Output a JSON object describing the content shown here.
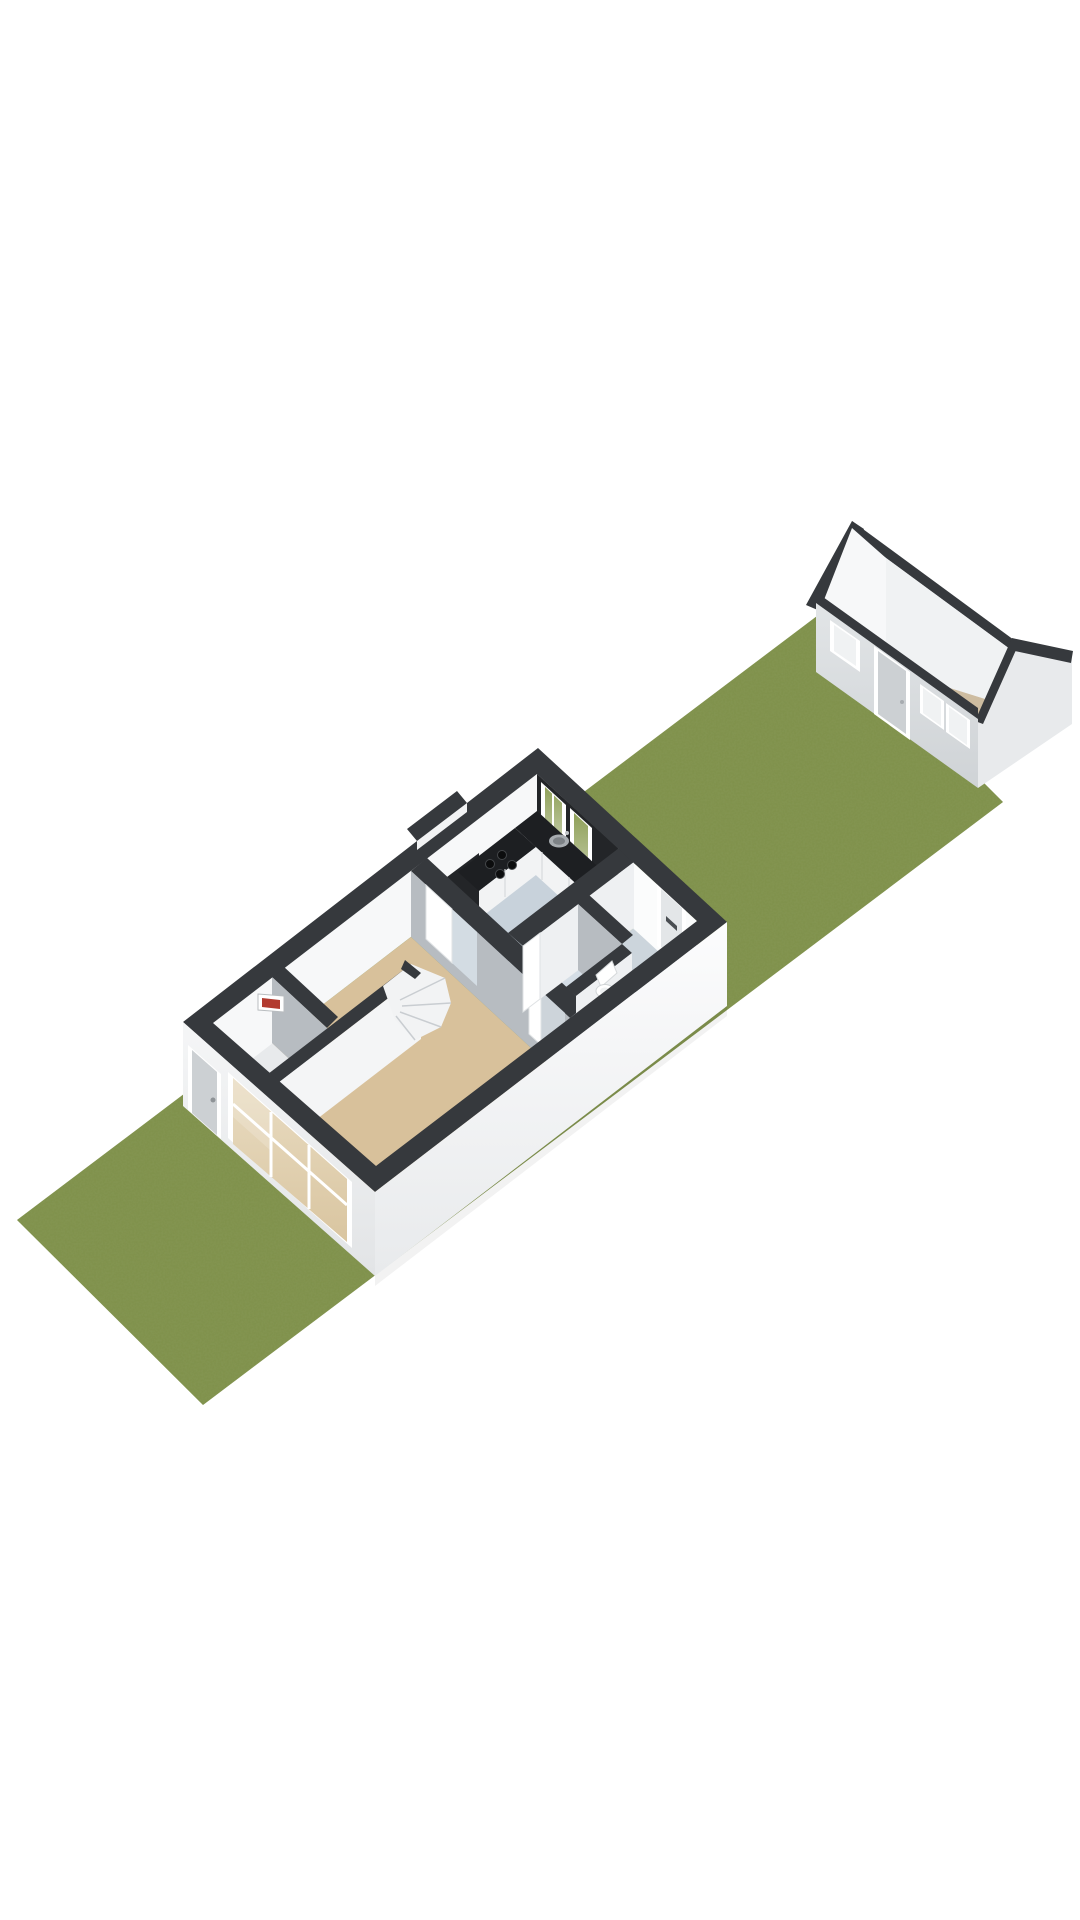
{
  "title": "3D floor plan - ground floor cutaway with garden strip and detached shed",
  "palette": {
    "bg": "#ffffff",
    "trim": "#36393d",
    "lawn": "#7e9049",
    "lawnDark": "#5e7036",
    "floorLiving": "#d8c19b",
    "floorKitchen": "#c8d2db",
    "floorHall": "#ccd5dc",
    "floorToilet": "#d5dee6",
    "floorShed": "#cdbca0",
    "closetFloor": "#e8eaec",
    "interiorWhite": "#f7f8f9",
    "interiorGray": "#b7bcc1",
    "wallWhite": "#fbfcfc",
    "counterDark": "#1d1f22",
    "backsplashDark": "#232528",
    "cabinetWhite": "#f2f3f4",
    "glassGreen": "#8fa058",
    "glassTan": "#d9c5a0",
    "doorGray": "#ccd0d3",
    "fuseRed": "#b23b30",
    "metal": "#a7acb0",
    "shedWallLight": "#e2e5e7",
    "shedWallMid": "#e8eaec",
    "shedInner": "#f0f2f3",
    "white": "#ffffff",
    "treadLine": "#c9cdd1",
    "seamLine": "#d8dadc",
    "extFaceTop": "#fcfcfd",
    "extFaceBottom": "#e8eaec",
    "extFaceTop2": "#f5f6f7",
    "extFaceBottom2": "#e2e4e6"
  },
  "scene": {
    "type": "3d-floor-plan-cutaway",
    "view": "isometric from south-east, plot runs diagonally bottom-left to top-right",
    "garden": {
      "element": "lawn-strip",
      "shape": "long parallelogram",
      "texture": "grass"
    },
    "main_house": {
      "element": "ground-floor-cutaway",
      "rooms": [
        {
          "name": "living-room",
          "floor": "floorLiving",
          "features": [
            "enclosed-winder-staircase",
            "meter-cupboard",
            "fuse-box",
            "front-door",
            "large-front-window-wall"
          ]
        },
        {
          "name": "kitchen",
          "floor": "floorKitchen",
          "features": [
            "l-shaped-counter",
            "four-burner-hob",
            "round-sink",
            "dark-backsplash",
            "tall-dark-unit",
            "two-garden-windows"
          ]
        },
        {
          "name": "hallway",
          "floor": "floorHall",
          "features": [
            "garden-door-with-letterbox"
          ]
        },
        {
          "name": "toilet-room",
          "floor": "floorToilet",
          "features": [
            "toilet"
          ]
        }
      ],
      "wall_top_trim": "trim",
      "chimney_bump_on_rear_wall": true
    },
    "shed": {
      "element": "detached-gabled-shed-cutaway",
      "floor": "floorShed",
      "features": [
        "open-gable-roofline-trim",
        "white-interior-gable-wall",
        "front-window",
        "front-door",
        "two-small-front-windows"
      ]
    }
  }
}
